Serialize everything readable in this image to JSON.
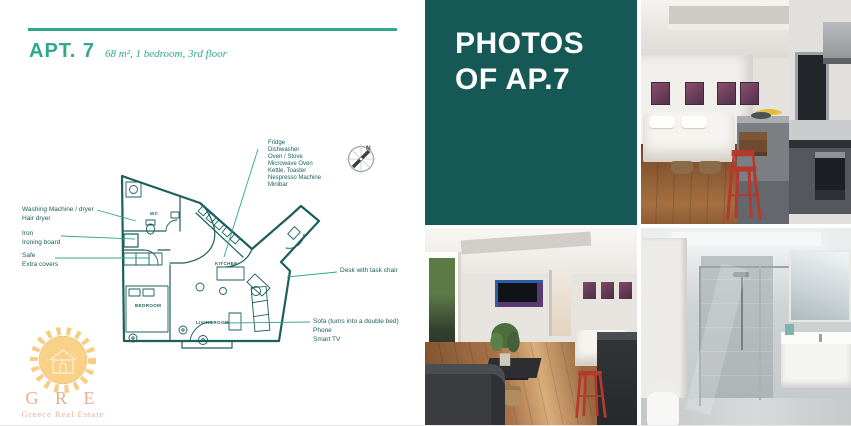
{
  "colors": {
    "accent_green": "#2fa98c",
    "teal_panel": "#165855",
    "plan_line": "#1d5f5f",
    "annotation_text": "#18605b",
    "logo_orange": "#f7c266",
    "logo_red": "#e59a7c",
    "stool_red": "#b33a2c"
  },
  "header": {
    "title": "APT. 7",
    "subtitle": "68 m², 1 bedroom, 3rd floor"
  },
  "photos_panel": {
    "title_line1": "PHOTOS",
    "title_line2": "OF AP.7"
  },
  "floor_plan": {
    "compass_label": "N",
    "room_labels": {
      "wc": "WC",
      "kitchen": "KITCHEN",
      "bedroom": "BEDROOM",
      "livingroom": "LIVINGROOM"
    },
    "annotations": {
      "kitchen_appliances": [
        "Fridge",
        "Dishwasher",
        "Oven / Stove",
        "Microwave Oven",
        "Kettle, Toaster",
        "Nespresso Machine",
        "Minibar"
      ],
      "laundry": [
        "Washing Machine / dryer",
        "Hair dryer"
      ],
      "ironing": [
        "Iron",
        "Ironing board"
      ],
      "safe": [
        "Safe",
        "Extra covers"
      ],
      "desk": [
        "Desk with task chair"
      ],
      "sofa": [
        "Sofa (turns into a double bed)",
        "Phone",
        "Smart TV"
      ]
    }
  },
  "logo": {
    "monogram": "G R E",
    "subtitle": "Greece Real Estate"
  },
  "photos": {
    "top": "studio-bedroom-and-kitchen-photo",
    "bottom_left": "living-room-photo",
    "bottom_right": "bathroom-photo"
  }
}
